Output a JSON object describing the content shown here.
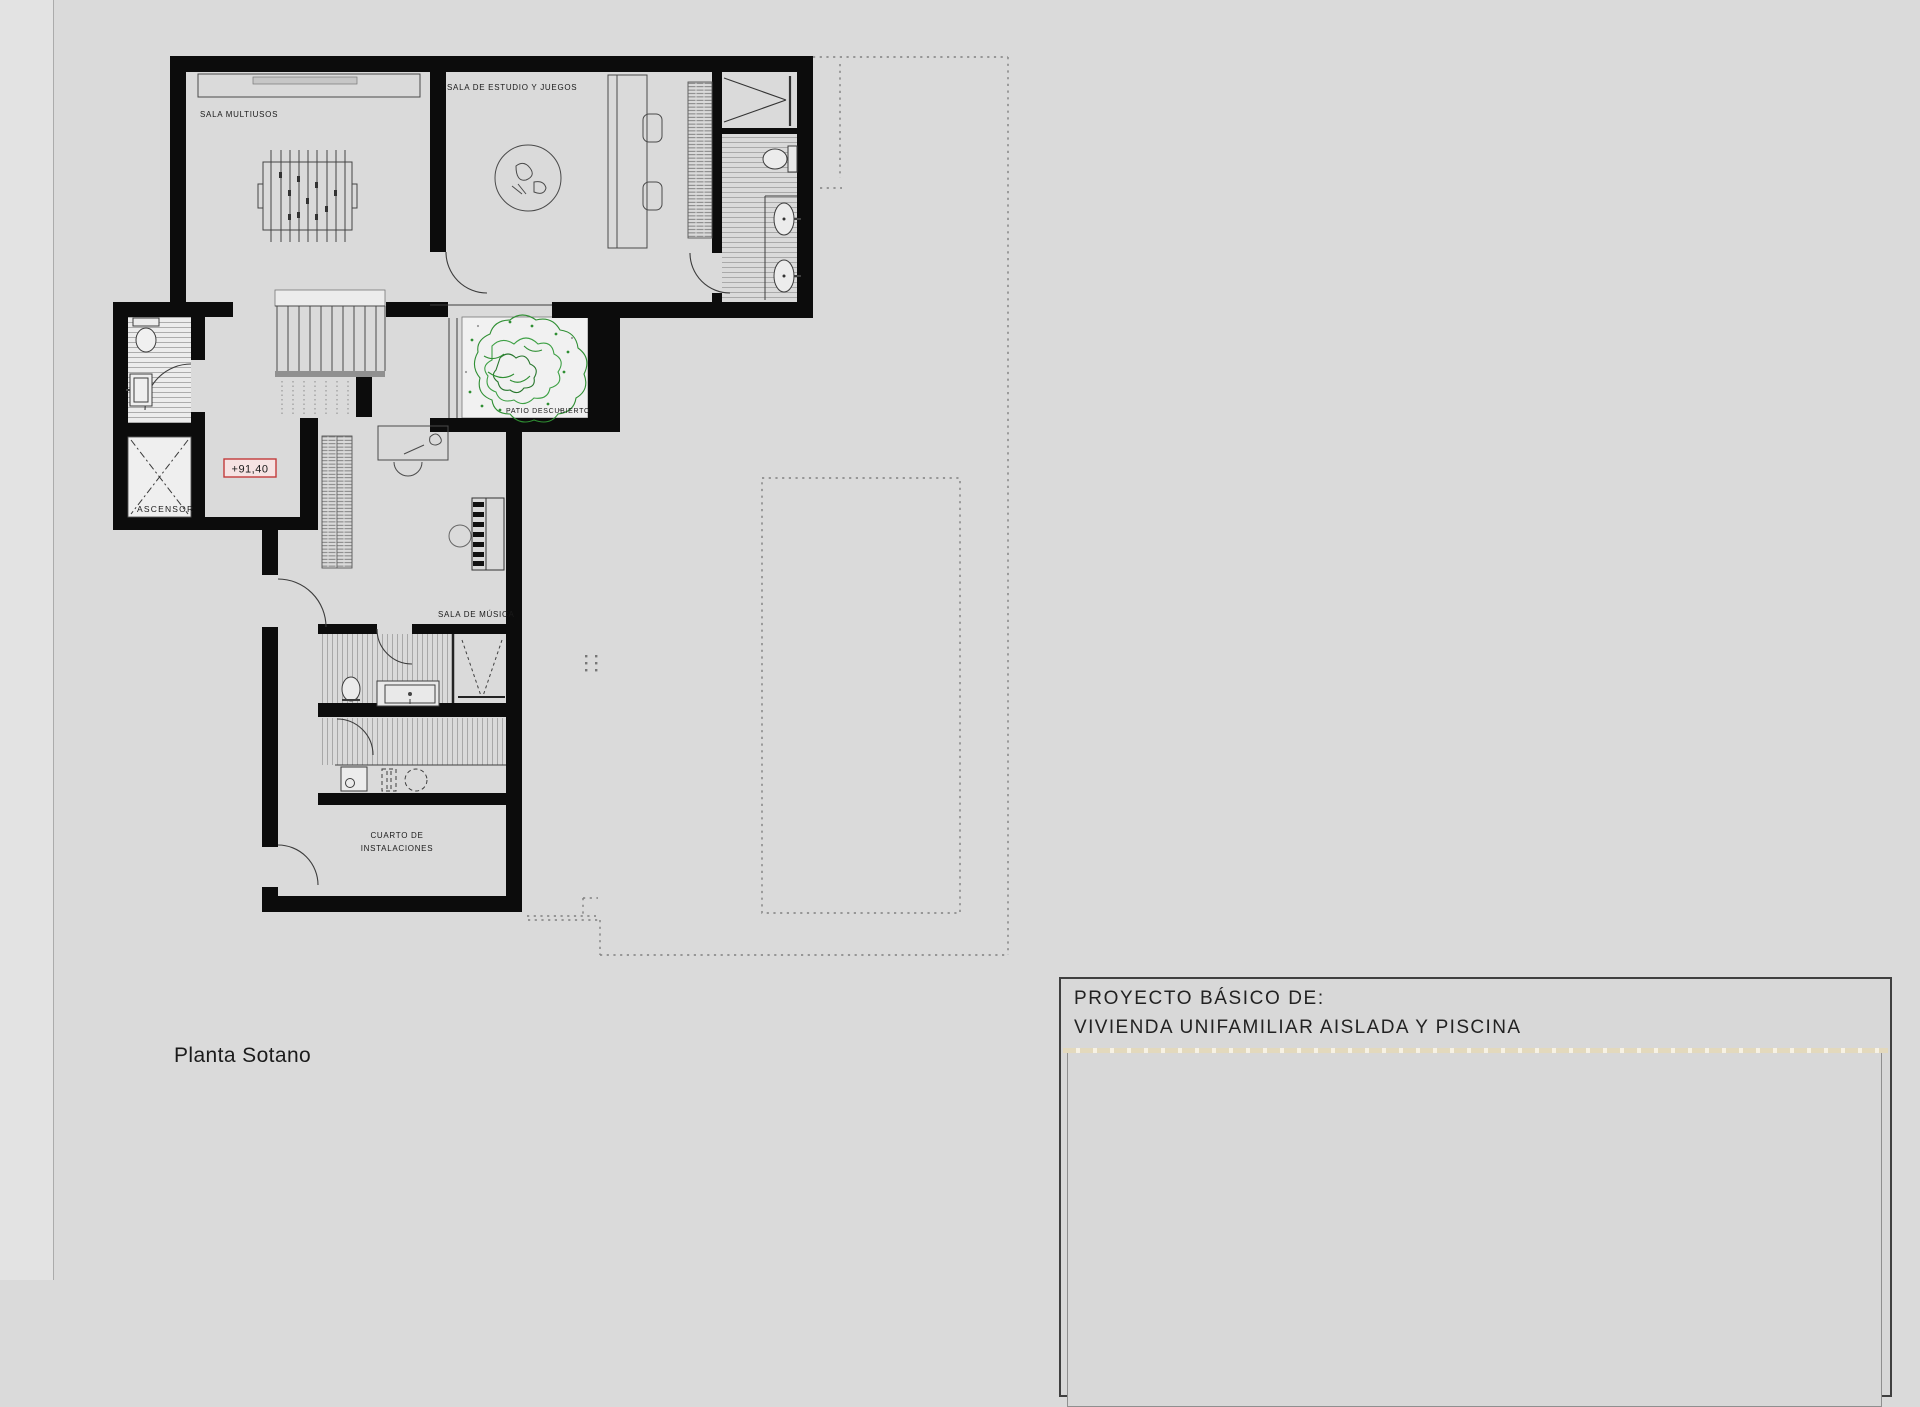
{
  "plan": {
    "caption": "Planta Sotano",
    "elevation": "+91,40",
    "rooms": {
      "multiusos": "SALA MULTIUSOS",
      "estudio": "SALA DE ESTUDIO Y JUEGOS",
      "patio": "PATIO DESCUBIERTO",
      "musica": "SALA DE MÚSICA",
      "instalaciones_line1": "CUARTO DE",
      "instalaciones_line2": "INSTALACIONES",
      "ascensor": "ASCENSOR"
    }
  },
  "title_block": {
    "prefix": "PROYECTO BÁSICO DE:",
    "project": "VIVIENDA UNIFAMILIAR AISLADA Y PISCINA"
  },
  "colors": {
    "wall": "#0c0c0c",
    "elevation_red": "#c23b3b",
    "elevation_bg": "#f6e3e3",
    "tree_green": "#2f8f33",
    "separator_tan": "#e3d9bd",
    "page_bg": "#dadada"
  }
}
